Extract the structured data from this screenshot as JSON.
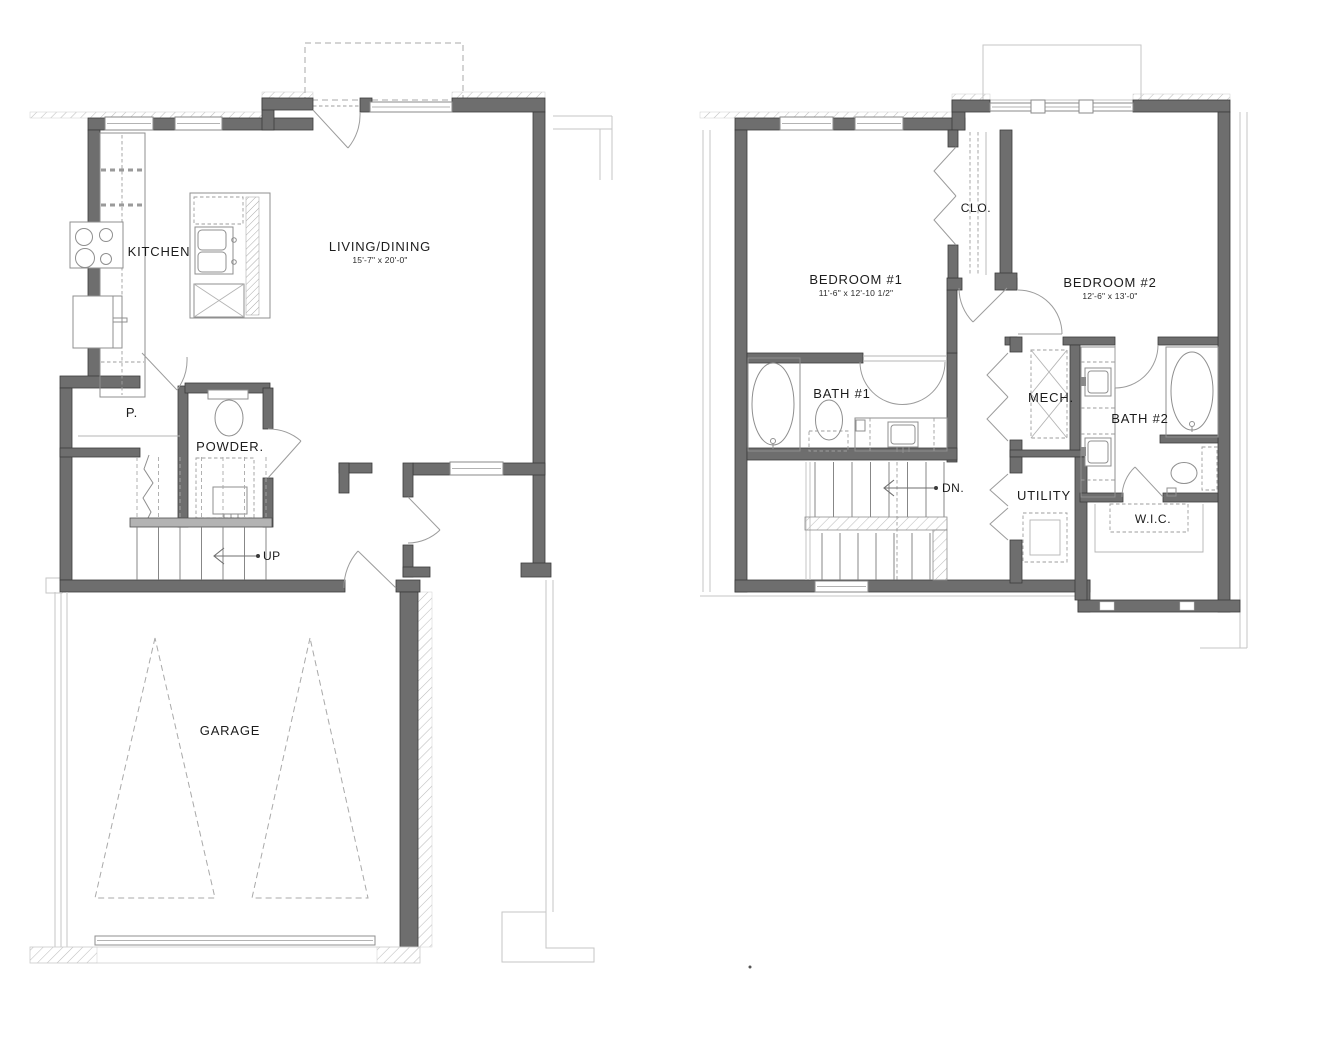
{
  "title": "Two-story townhome floor plans",
  "colors": {
    "background": "#ffffff",
    "wall_fill": "#6e6e6e",
    "wall_stroke": "#3b3b3b",
    "fixture_line": "#8f8f8f",
    "light_line": "#c6c6c6",
    "text": "#1c1c1c"
  },
  "plans": {
    "first_floor": {
      "kitchen": "KITCHEN",
      "living": "LIVING/DINING",
      "living_dims": "15'-7\" x 20'-0\"",
      "pantry": "P.",
      "powder": "POWDER.",
      "stairs_up": "UP",
      "garage": "GARAGE"
    },
    "second_floor": {
      "closet": "CLO.",
      "bedroom1": "BEDROOM #1",
      "bedroom1_dims": "11'-6\" x 12'-10 1/2\"",
      "bedroom2": "BEDROOM #2",
      "bedroom2_dims": "12'-6\" x 13'-0\"",
      "bath1": "BATH #1",
      "bath2": "BATH #2",
      "mech": "MECH.",
      "utility": "UTILITY",
      "wic": "W.I.C.",
      "stairs_down": "DN."
    }
  }
}
